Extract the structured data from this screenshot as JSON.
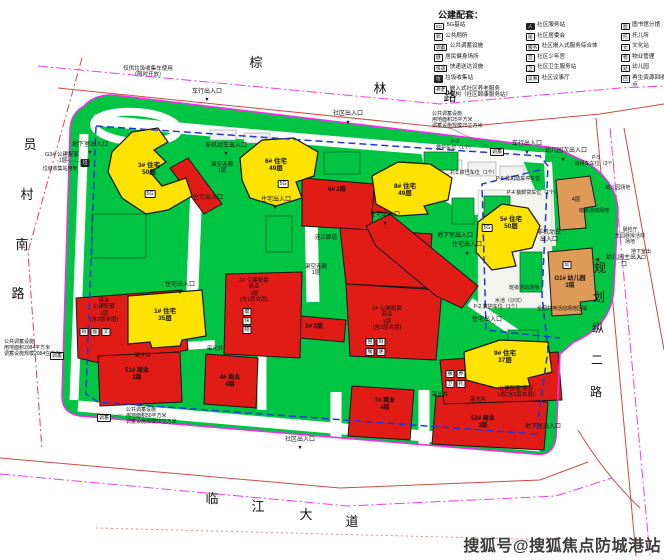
{
  "legend": {
    "title": "公建配套：",
    "columns": [
      [
        {
          "i": "5G",
          "t": "5G基站"
        },
        {
          "i": "厕",
          "t": "公共厕所"
        },
        {
          "i": "调蓄",
          "t": "公共调蓄设施"
        },
        {
          "i": "健",
          "t": "居民健身场所"
        },
        {
          "i": "快递",
          "t": "快递送达设施"
        },
        {
          "i": "垃",
          "t": "垃圾收集站",
          "dark": true
        },
        {
          "i": "养老",
          "t": "嵌入式社区养老服务\n机构（社区颐康服务站）"
        }
      ],
      [
        {
          "i": "人",
          "t": "社区服务站",
          "dark": true
        },
        {
          "i": "居",
          "t": "社区居委会"
        },
        {
          "i": "服务",
          "t": "社区嵌入式服务综合体"
        },
        {
          "i": "宫",
          "t": "社区少年宫"
        },
        {
          "i": "卫",
          "t": "社区卫生服务站"
        },
        {
          "i": "议事",
          "t": "社区议事厅"
        }
      ],
      [
        {
          "i": "图",
          "t": "图书馆分馆"
        },
        {
          "i": "托",
          "t": "托儿所"
        },
        {
          "i": "文",
          "t": "文化站"
        },
        {
          "i": "物",
          "t": "物业管理"
        },
        {
          "i": "幼",
          "t": "幼儿园"
        },
        {
          "i": "回",
          "t": "再生资源回收点"
        }
      ]
    ]
  },
  "watermark": {
    "text": "搜狐号@搜狐焦点防城港站"
  },
  "map": {
    "road_names": [
      {
        "t": "棕",
        "x": 256,
        "y": 56,
        "s": 13
      },
      {
        "t": "林",
        "x": 380,
        "y": 82,
        "s": 13
      },
      {
        "t": "路",
        "x": 450,
        "y": 90,
        "s": 13
      },
      {
        "t": "员",
        "x": 30,
        "y": 138,
        "s": 13
      },
      {
        "t": "村",
        "x": 27,
        "y": 188,
        "s": 13
      },
      {
        "t": "南",
        "x": 22,
        "y": 238,
        "s": 13
      },
      {
        "t": "路",
        "x": 18,
        "y": 287,
        "s": 13
      },
      {
        "t": "临",
        "x": 212,
        "y": 492,
        "s": 13
      },
      {
        "t": "江",
        "x": 258,
        "y": 500,
        "s": 13
      },
      {
        "t": "大",
        "x": 306,
        "y": 508,
        "s": 13
      },
      {
        "t": "道",
        "x": 352,
        "y": 515,
        "s": 13
      },
      {
        "t": "规",
        "x": 600,
        "y": 262,
        "s": 12
      },
      {
        "t": "划",
        "x": 599,
        "y": 291,
        "s": 12
      },
      {
        "t": "纵",
        "x": 598,
        "y": 322,
        "s": 12
      },
      {
        "t": "二",
        "x": 597,
        "y": 354,
        "s": 12
      },
      {
        "t": "路",
        "x": 596,
        "y": 386,
        "s": 12
      }
    ],
    "buildings": [
      {
        "t": "3# 住宅\n50层",
        "x": 149,
        "y": 162,
        "s": 6.5,
        "b": 1,
        "n": "label-building-3"
      },
      {
        "t": "6# 住宅\n49层",
        "x": 276,
        "y": 158,
        "s": 6.5,
        "b": 1,
        "n": "label-building-6"
      },
      {
        "t": "8# 住宅\n49层",
        "x": 405,
        "y": 183,
        "s": 6.5,
        "b": 1,
        "n": "label-building-8"
      },
      {
        "t": "5# 住宅\n50层",
        "x": 511,
        "y": 216,
        "s": 6.5,
        "b": 1,
        "n": "label-building-5"
      },
      {
        "t": "1# 住宅\n35层",
        "x": 165,
        "y": 308,
        "s": 6.5,
        "b": 1,
        "n": "label-building-1"
      },
      {
        "t": "9# 住宅\n37层",
        "x": 505,
        "y": 350,
        "s": 6.5,
        "b": 1,
        "n": "label-building-9"
      },
      {
        "t": "6#  2层",
        "x": 337,
        "y": 187,
        "s": 6,
        "b": 1,
        "n": "label-building-6-podium"
      },
      {
        "t": "2#  2层",
        "x": 314,
        "y": 324,
        "s": 6,
        "b": 1,
        "n": "label-building-2-podium"
      },
      {
        "t": "51# 商业\n2层",
        "x": 137,
        "y": 368,
        "s": 6,
        "b": 1,
        "n": "label-building-51"
      },
      {
        "t": "4# 商业\n4层",
        "x": 230,
        "y": 375,
        "s": 6,
        "b": 1,
        "n": "label-building-4"
      },
      {
        "t": "7# 商业\n4层",
        "x": 385,
        "y": 398,
        "s": 6,
        "b": 1,
        "n": "label-building-7"
      },
      {
        "t": "52# 商业\n3层",
        "x": 483,
        "y": 416,
        "s": 6,
        "b": 1,
        "n": "label-building-52"
      },
      {
        "t": "商业\n公建配套\n1层\n(含2层夹层)",
        "x": 104,
        "y": 298,
        "s": 5.5,
        "n": "label-shangye-peitao"
      },
      {
        "t": "2# 公建配套\n商业\n1层\n(含1层夹层)",
        "x": 254,
        "y": 278,
        "s": 5.5,
        "n": "label-2-peitao-west"
      },
      {
        "t": "2# 公建配套\n商业\n1层\n(含2层夹层)",
        "x": 387,
        "y": 306,
        "s": 5.5,
        "n": "label-2-peitao-center"
      },
      {
        "t": "公建配套  商业\n1层(含2层夹层)",
        "x": 516,
        "y": 386,
        "s": 5.5,
        "n": "label-peitao-9"
      },
      {
        "t": "G1# 幼儿园\n3层",
        "x": 570,
        "y": 276,
        "s": 6,
        "b": 1,
        "n": "label-kindergarten"
      },
      {
        "t": "4层",
        "x": 576,
        "y": 197,
        "s": 5.5,
        "n": "label-orange-4f"
      },
      {
        "t": "G3# 公建配套\n-1层",
        "x": 62,
        "y": 152,
        "s": 5.5,
        "n": "label-g3-peitao"
      }
    ],
    "annotations": [
      {
        "t": "车行出入口",
        "x": 207,
        "y": 89
      },
      {
        "t": "社区出入口",
        "x": 348,
        "y": 111
      },
      {
        "t": "车行出入口",
        "x": 527,
        "y": 141
      },
      {
        "t": "幼儿园次出入口",
        "x": 566,
        "y": 148
      },
      {
        "t": "社区出入口",
        "x": 300,
        "y": 437
      },
      {
        "t": "幼儿园主出入口",
        "x": 624,
        "y": 255
      },
      {
        "t": "住宅出入口",
        "x": 208,
        "y": 195
      },
      {
        "t": "住宅出入口",
        "x": 276,
        "y": 197
      },
      {
        "t": "住宅出入口",
        "x": 385,
        "y": 212
      },
      {
        "t": "住宅出入口",
        "x": 467,
        "y": 242
      },
      {
        "t": "住宅出入口",
        "x": 180,
        "y": 282
      },
      {
        "t": "住宅出入口",
        "x": 487,
        "y": 317
      },
      {
        "t": "非机动车出入口",
        "x": 226,
        "y": 143
      },
      {
        "t": "非机动车\n出入口",
        "x": 549,
        "y": 230
      },
      {
        "t": "地下室出入口",
        "x": 90,
        "y": 142
      },
      {
        "t": "地下室出入口",
        "x": 455,
        "y": 233
      },
      {
        "t": "地下室出入口",
        "x": 543,
        "y": 424
      },
      {
        "t": "地下室出入口",
        "x": 641,
        "y": 250,
        "s": 5
      },
      {
        "t": "架空连廊\n1层",
        "x": 222,
        "y": 162,
        "s": 5.5
      },
      {
        "t": "架空连廊\n1层",
        "x": 316,
        "y": 264,
        "s": 5.5
      },
      {
        "t": "连江廊道",
        "x": 326,
        "y": 235,
        "s": 5.5
      },
      {
        "t": "采光井",
        "x": 143,
        "y": 353,
        "s": 5.5
      },
      {
        "t": "采光井",
        "x": 215,
        "y": 346,
        "s": 5.5
      },
      {
        "t": "采光井",
        "x": 440,
        "y": 392,
        "s": 5.5
      },
      {
        "t": "采光井",
        "x": 478,
        "y": 397,
        "s": 5.5
      },
      {
        "t": "P-1 校巴车位（1个）",
        "x": 474,
        "y": 171,
        "s": 5
      },
      {
        "t": "P-2 救护车位（1个）",
        "x": 497,
        "y": 305,
        "s": 5
      },
      {
        "t": "P-3\n救护车位（1个）",
        "x": 455,
        "y": 140,
        "s": 5
      },
      {
        "t": "P-4 装卸货车位（1个）",
        "x": 533,
        "y": 191,
        "s": 5
      },
      {
        "t": "P-5\n出租车车位（3个）",
        "x": 596,
        "y": 156,
        "s": 5
      },
      {
        "t": "P-6 非机动车停车位",
        "x": 518,
        "y": 177,
        "s": 5
      },
      {
        "t": "班级活动场地",
        "x": 594,
        "y": 209,
        "s": 5
      },
      {
        "t": "班级活动场地",
        "x": 524,
        "y": 286,
        "s": 5
      },
      {
        "t": "水池（沙坑）",
        "x": 510,
        "y": 299,
        "s": 5
      },
      {
        "t": "全园共用活动场地区域",
        "x": 562,
        "y": 307,
        "s": 5
      },
      {
        "t": "晨检厅\n全园晨操活动场地",
        "x": 630,
        "y": 228,
        "s": 5
      },
      {
        "t": "幼儿园场地",
        "x": 618,
        "y": 186,
        "s": 5
      },
      {
        "t": "仅供垃圾收集车使用\n（限时开放）",
        "x": 148,
        "y": 66,
        "s": 5.5
      },
      {
        "t": "垃圾收集站用地",
        "x": 60,
        "y": 167,
        "s": 5
      },
      {
        "t": "公共调蓄设施\n用地面积2084平方米\n调蓄设施规模2084立方米",
        "x": 4,
        "y": 340,
        "s": 5,
        "a": "l"
      },
      {
        "t": "公共调蓄设施\n用地面积50平方米\n调蓄设施规模50立方米",
        "x": 126,
        "y": 408,
        "s": 5,
        "a": "l"
      },
      {
        "t": "公共调蓄设施\n用地面积25平方米\n调蓄设施规模25立方米",
        "x": 432,
        "y": 112,
        "s": 5,
        "a": "l"
      }
    ],
    "arrows": [
      {
        "t": "▼",
        "x": 207,
        "y": 97
      },
      {
        "t": "▼",
        "x": 348,
        "y": 120
      },
      {
        "t": "▼",
        "x": 527,
        "y": 150
      },
      {
        "t": "▼",
        "x": 563,
        "y": 157
      },
      {
        "t": "▼",
        "x": 300,
        "y": 445
      },
      {
        "t": "▼",
        "x": 180,
        "y": 290
      },
      {
        "t": "▼",
        "x": 90,
        "y": 150
      },
      {
        "t": "▼",
        "x": 385,
        "y": 221
      },
      {
        "t": "▼",
        "x": 467,
        "y": 251
      },
      {
        "t": "▼",
        "x": 226,
        "y": 151
      },
      {
        "t": "◀",
        "x": 597,
        "y": 257
      },
      {
        "t": "▼",
        "x": 275,
        "y": 205
      }
    ],
    "icons": [
      {
        "t": "5G",
        "x": 150,
        "y": 190
      },
      {
        "t": "5G",
        "x": 283,
        "y": 180
      },
      {
        "t": "5G",
        "x": 487,
        "y": 224
      },
      {
        "t": "厕",
        "x": 84,
        "y": 328
      },
      {
        "t": "图",
        "x": 95,
        "y": 328
      },
      {
        "t": "文",
        "x": 106,
        "y": 328
      },
      {
        "t": "健",
        "x": 247,
        "y": 308
      },
      {
        "t": "快",
        "x": 247,
        "y": 317
      },
      {
        "t": "物",
        "x": 247,
        "y": 326
      },
      {
        "t": "宫",
        "x": 370,
        "y": 338
      },
      {
        "t": "厕",
        "x": 381,
        "y": 338
      },
      {
        "t": "服",
        "x": 370,
        "y": 348
      },
      {
        "t": "递",
        "x": 381,
        "y": 348
      },
      {
        "t": "服",
        "x": 450,
        "y": 370
      },
      {
        "t": "养",
        "x": 461,
        "y": 370
      },
      {
        "t": "卫",
        "x": 450,
        "y": 380
      },
      {
        "t": "托",
        "x": 461,
        "y": 380
      },
      {
        "t": "幼",
        "x": 567,
        "y": 261
      },
      {
        "t": "垃",
        "x": 85,
        "y": 159,
        "d": 1
      },
      {
        "t": "调蓄",
        "x": 57,
        "y": 352
      },
      {
        "t": "调蓄",
        "x": 104,
        "y": 414
      },
      {
        "t": "调蓄",
        "x": 497,
        "y": 148
      }
    ]
  }
}
